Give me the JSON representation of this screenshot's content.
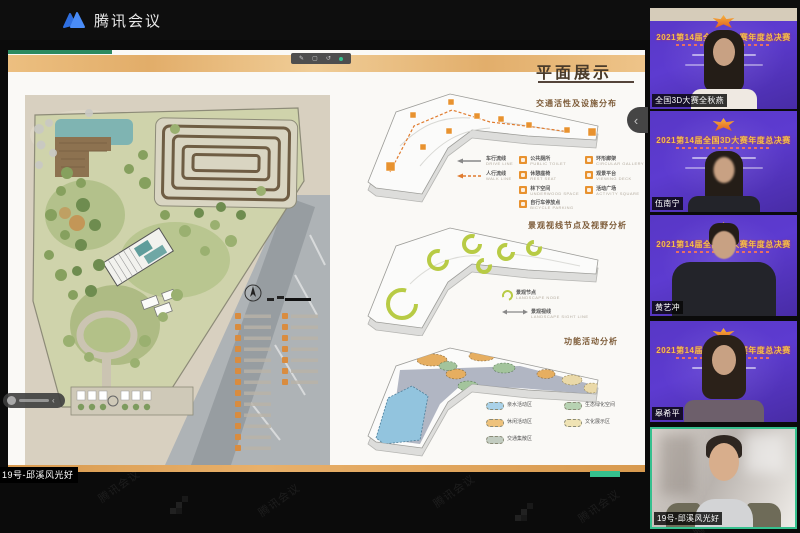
{
  "app": {
    "brand": "腾讯会议"
  },
  "watermark": {
    "text": "腾讯会议"
  },
  "share": {
    "presenter_label": "19号-邱溪风光好",
    "slide": {
      "title": "平面展示",
      "diagrams": [
        {
          "title": "交通活性及设施分布",
          "arrow_legend": [
            {
              "label": "车行流线",
              "sub": "DRIVE LINE"
            },
            {
              "label": "人行流线",
              "sub": "WALK LINE"
            }
          ],
          "legend_left": [
            {
              "label": "公共厕所",
              "sub": "PUBLIC TOILET"
            },
            {
              "label": "休憩座椅",
              "sub": "REST SEAT"
            },
            {
              "label": "林下空间",
              "sub": "UNDERWOOD SPACE"
            },
            {
              "label": "自行车停放点",
              "sub": "BICYCLE PARKING"
            }
          ],
          "legend_right": [
            {
              "label": "环形廊架",
              "sub": "CIRCULAR GALLERY"
            },
            {
              "label": "观景平台",
              "sub": "VIEWING DECK"
            },
            {
              "label": "活动广场",
              "sub": "ACTIVITY SQUARE"
            }
          ]
        },
        {
          "title": "景观视线节点及视野分析",
          "legend": [
            {
              "label": "景观节点",
              "sub": "LANDSCAPE NODE"
            },
            {
              "label": "景观视线",
              "sub": "LANDSCAPE SIGHT LINE"
            }
          ]
        },
        {
          "title": "功能活动分析",
          "legend": [
            {
              "label": "亲水活动区",
              "color": "#a9d1e8"
            },
            {
              "label": "生态绿化空间",
              "color": "#b7d2b2"
            },
            {
              "label": "休闲活动区",
              "color": "#eec27c"
            },
            {
              "label": "文化展示区",
              "color": "#efe3b4"
            },
            {
              "label": "交通集散区",
              "color": "#c2ccc0"
            }
          ]
        }
      ],
      "plan_legend": {
        "rows_left": 13,
        "rows_right": 7
      }
    }
  },
  "sidebar": {
    "collapse_icon": "‹",
    "participants": [
      {
        "name": "全国3D大赛全秋燕",
        "background_title": "2021第14届全国3D大赛年度总决赛",
        "type": "virtual-bg",
        "active": false
      },
      {
        "name": "伍南宁",
        "background_title": "2021第14届全国3D大赛年度总决赛",
        "type": "virtual-bg",
        "active": false
      },
      {
        "name": "黄艺冲",
        "background_title": "2021第14届全国3D大赛年度总决赛",
        "type": "virtual-bg",
        "active": false
      },
      {
        "name": "皋希平",
        "background_title": "2021第14届全国3D大赛年度总决赛",
        "type": "virtual-bg",
        "active": false
      },
      {
        "name": "19号-邱溪风光好",
        "type": "camera",
        "active": true
      }
    ]
  },
  "colors": {
    "accent_green": "#35c08e",
    "kraft_orange": "#e8b06a",
    "legend_orange": "#e8922f",
    "virtual_bg_purple": "#5d3bd0",
    "title_gold": "#f3bf4a"
  }
}
